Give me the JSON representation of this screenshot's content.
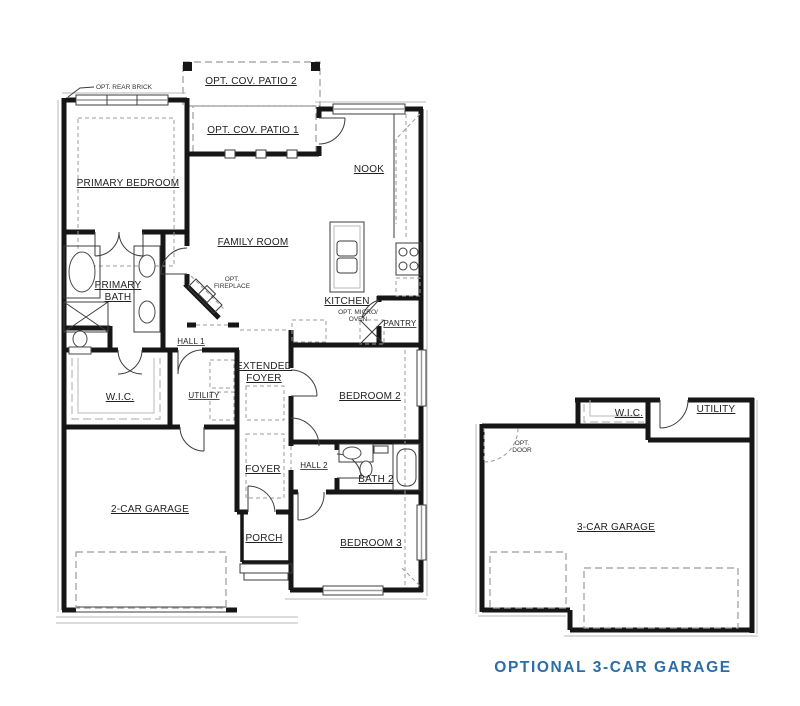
{
  "colors": {
    "background": "#ffffff",
    "wall": "#161616",
    "dashed_line": "#9b9b9b",
    "caption": "#2b6da8"
  },
  "main_plan": {
    "labels": {
      "opt_rear_brick": "OPT. REAR BRICK",
      "opt_cov_patio_2": "OPT. COV. PATIO 2",
      "opt_cov_patio_1": "OPT. COV. PATIO 1",
      "primary_bedroom": "PRIMARY BEDROOM",
      "nook": "NOOK",
      "family_room": "FAMILY ROOM",
      "primary_bath_1": "PRIMARY",
      "primary_bath_2": "BATH",
      "opt_fireplace_1": "OPT.",
      "opt_fireplace_2": "FIREPLACE",
      "kitchen": "KITCHEN",
      "opt_micro_1": "OPT. MICRO/",
      "opt_micro_2": "OVEN",
      "pantry": "PANTRY",
      "hall_1": "HALL 1",
      "extended_foyer_1": "EXTENDED",
      "extended_foyer_2": "FOYER",
      "wic": "W.I.C.",
      "utility": "UTILITY",
      "bedroom_2": "BEDROOM 2",
      "foyer": "FOYER",
      "hall_2": "HALL 2",
      "bath_2": "BATH 2",
      "garage": "2-CAR GARAGE",
      "porch": "PORCH",
      "bedroom_3": "BEDROOM 3"
    }
  },
  "optional_plan": {
    "labels": {
      "wic": "W.I.C.",
      "utility": "UTILITY",
      "opt_door_1": "OPT.",
      "opt_door_2": "DOOR",
      "garage": "3-CAR GARAGE"
    },
    "caption": "OPTIONAL 3-CAR GARAGE"
  }
}
